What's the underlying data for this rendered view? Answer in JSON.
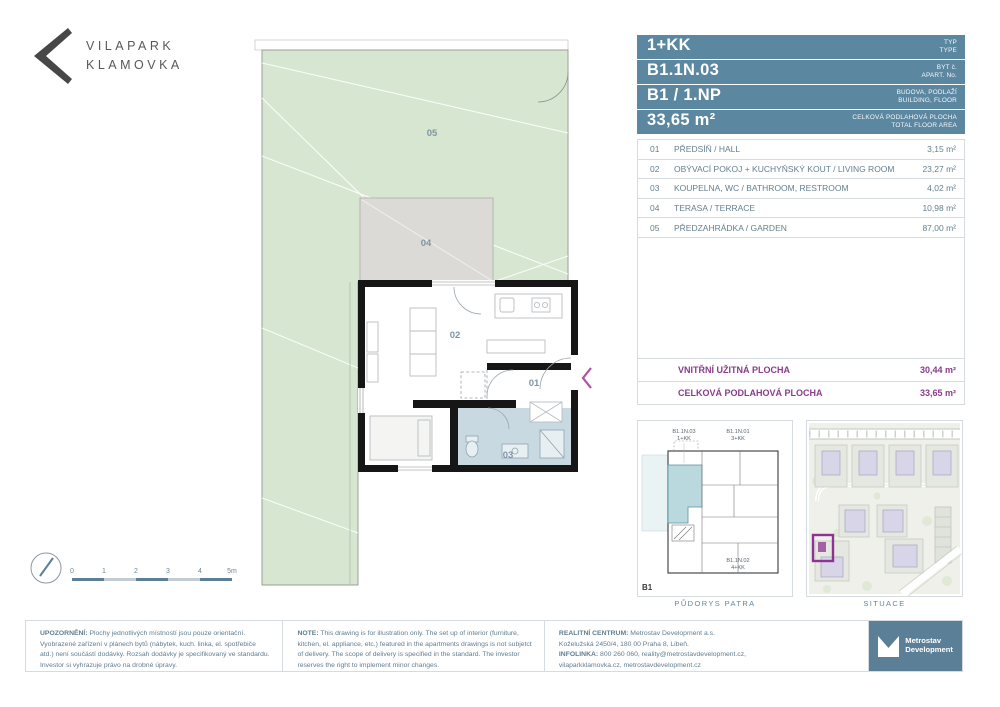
{
  "brand": {
    "line1": "VILAPARK",
    "line2": "KLAMOVKA"
  },
  "header": {
    "rows": [
      {
        "value": "1+KK",
        "label_cz": "TYP",
        "label_en": "TYPE"
      },
      {
        "value": "B1.1N.03",
        "label_cz": "BYT č.",
        "label_en": "APART. No."
      },
      {
        "value": "B1 / 1.NP",
        "label_cz": "BUDOVA, PODLAŽÍ",
        "label_en": "BUILDING, FLOOR"
      },
      {
        "value": "33,65 m²",
        "label_cz": "CELKOVÁ PODLAHOVÁ PLOCHA",
        "label_en": "TOTAL FLOOR AREA"
      }
    ]
  },
  "rooms": [
    {
      "num": "01",
      "name": "PŘEDSÍŇ / HALL",
      "area": "3,15 m²"
    },
    {
      "num": "02",
      "name": "OBÝVACÍ POKOJ + KUCHYŇSKÝ KOUT / LIVING ROOM",
      "area": "23,27 m²"
    },
    {
      "num": "03",
      "name": "KOUPELNA, WC / BATHROOM, RESTROOM",
      "area": "4,02 m²"
    },
    {
      "num": "04",
      "name": "TERASA / TERRACE",
      "area": "10,98 m²"
    },
    {
      "num": "05",
      "name": "PŘEDZAHRÁDKA / GARDEN",
      "area": "87,00 m²"
    }
  ],
  "summary": [
    {
      "label": "VNITŘNÍ UŽITNÁ PLOCHA",
      "value": "30,44 m²"
    },
    {
      "label": "CELKOVÁ PODLAHOVÁ PLOCHA",
      "value": "33,65 m²"
    }
  ],
  "plan": {
    "room_labels": {
      "r01": "01",
      "r02": "02",
      "r03": "03",
      "r04": "04",
      "r05": "05"
    },
    "scale_ticks": [
      "0",
      "1",
      "2",
      "3",
      "4",
      "5m"
    ]
  },
  "mini_plan": {
    "unit_self_id": "B1.1N.03",
    "unit_self_type": "1+KK",
    "unit1_id": "B1.1N.01",
    "unit1_type": "3+KK",
    "unit2_id": "B1.1N.02",
    "unit2_type": "4+KK",
    "building": "B1",
    "caption": "PŮDORYS PATRA"
  },
  "situace": {
    "caption": "SITUACE"
  },
  "footer": {
    "upozorneni_label": "UPOZORNĚNÍ:",
    "upozorneni_text": " Plochy jednotlivých místností jsou pouze orientační. Vyobrazené zařízení v plánech bytů (nábytek, kuch. linka, el. spotřebiče atd.) není součástí dodávky. Rozsah dodávky je specifikovaný ve standardu. Investor si vyhrazuje právo na drobné úpravy.",
    "note_label": "NOTE:",
    "note_text": " This drawing is for illustration only. The set up of interior (furniture, kitchen, el. appliance, etc.) featured in the apartments drawings is not subjetct of delivery. The scope of delivery is specified in the standard. The investor reserves the right to implement minor changes.",
    "realitni_label": "REALITNÍ CENTRUM:",
    "realitni_text": " Metrostav Development a.s.",
    "realitni_line2": "Koželužská 2450/4, 180 00 Praha 8, Libeň.",
    "infolinka_label": "INFOLINKA:",
    "infolinka_text": " 800 260 060, reality@metrostavdevelopment.cz,",
    "realitni_line4": "vilaparkklamovka.cz, metrostavdevelopment.cz"
  },
  "metrostav_logo": {
    "line1": "Metrostav",
    "line2": "Development"
  },
  "colors": {
    "slate_header": "#5b87a1",
    "slate_logo": "#5b7f96",
    "purple_accent": "#8a3b8c",
    "magenta_entry": "#b14fa0",
    "garden_green": "#d7e6d0",
    "terrace_grey": "#dcdad6",
    "bath_blue": "#c9d9e1",
    "teal_highlight": "#b9d9df",
    "border_grey": "#d6dbdf",
    "text_blue": "#64808f"
  }
}
